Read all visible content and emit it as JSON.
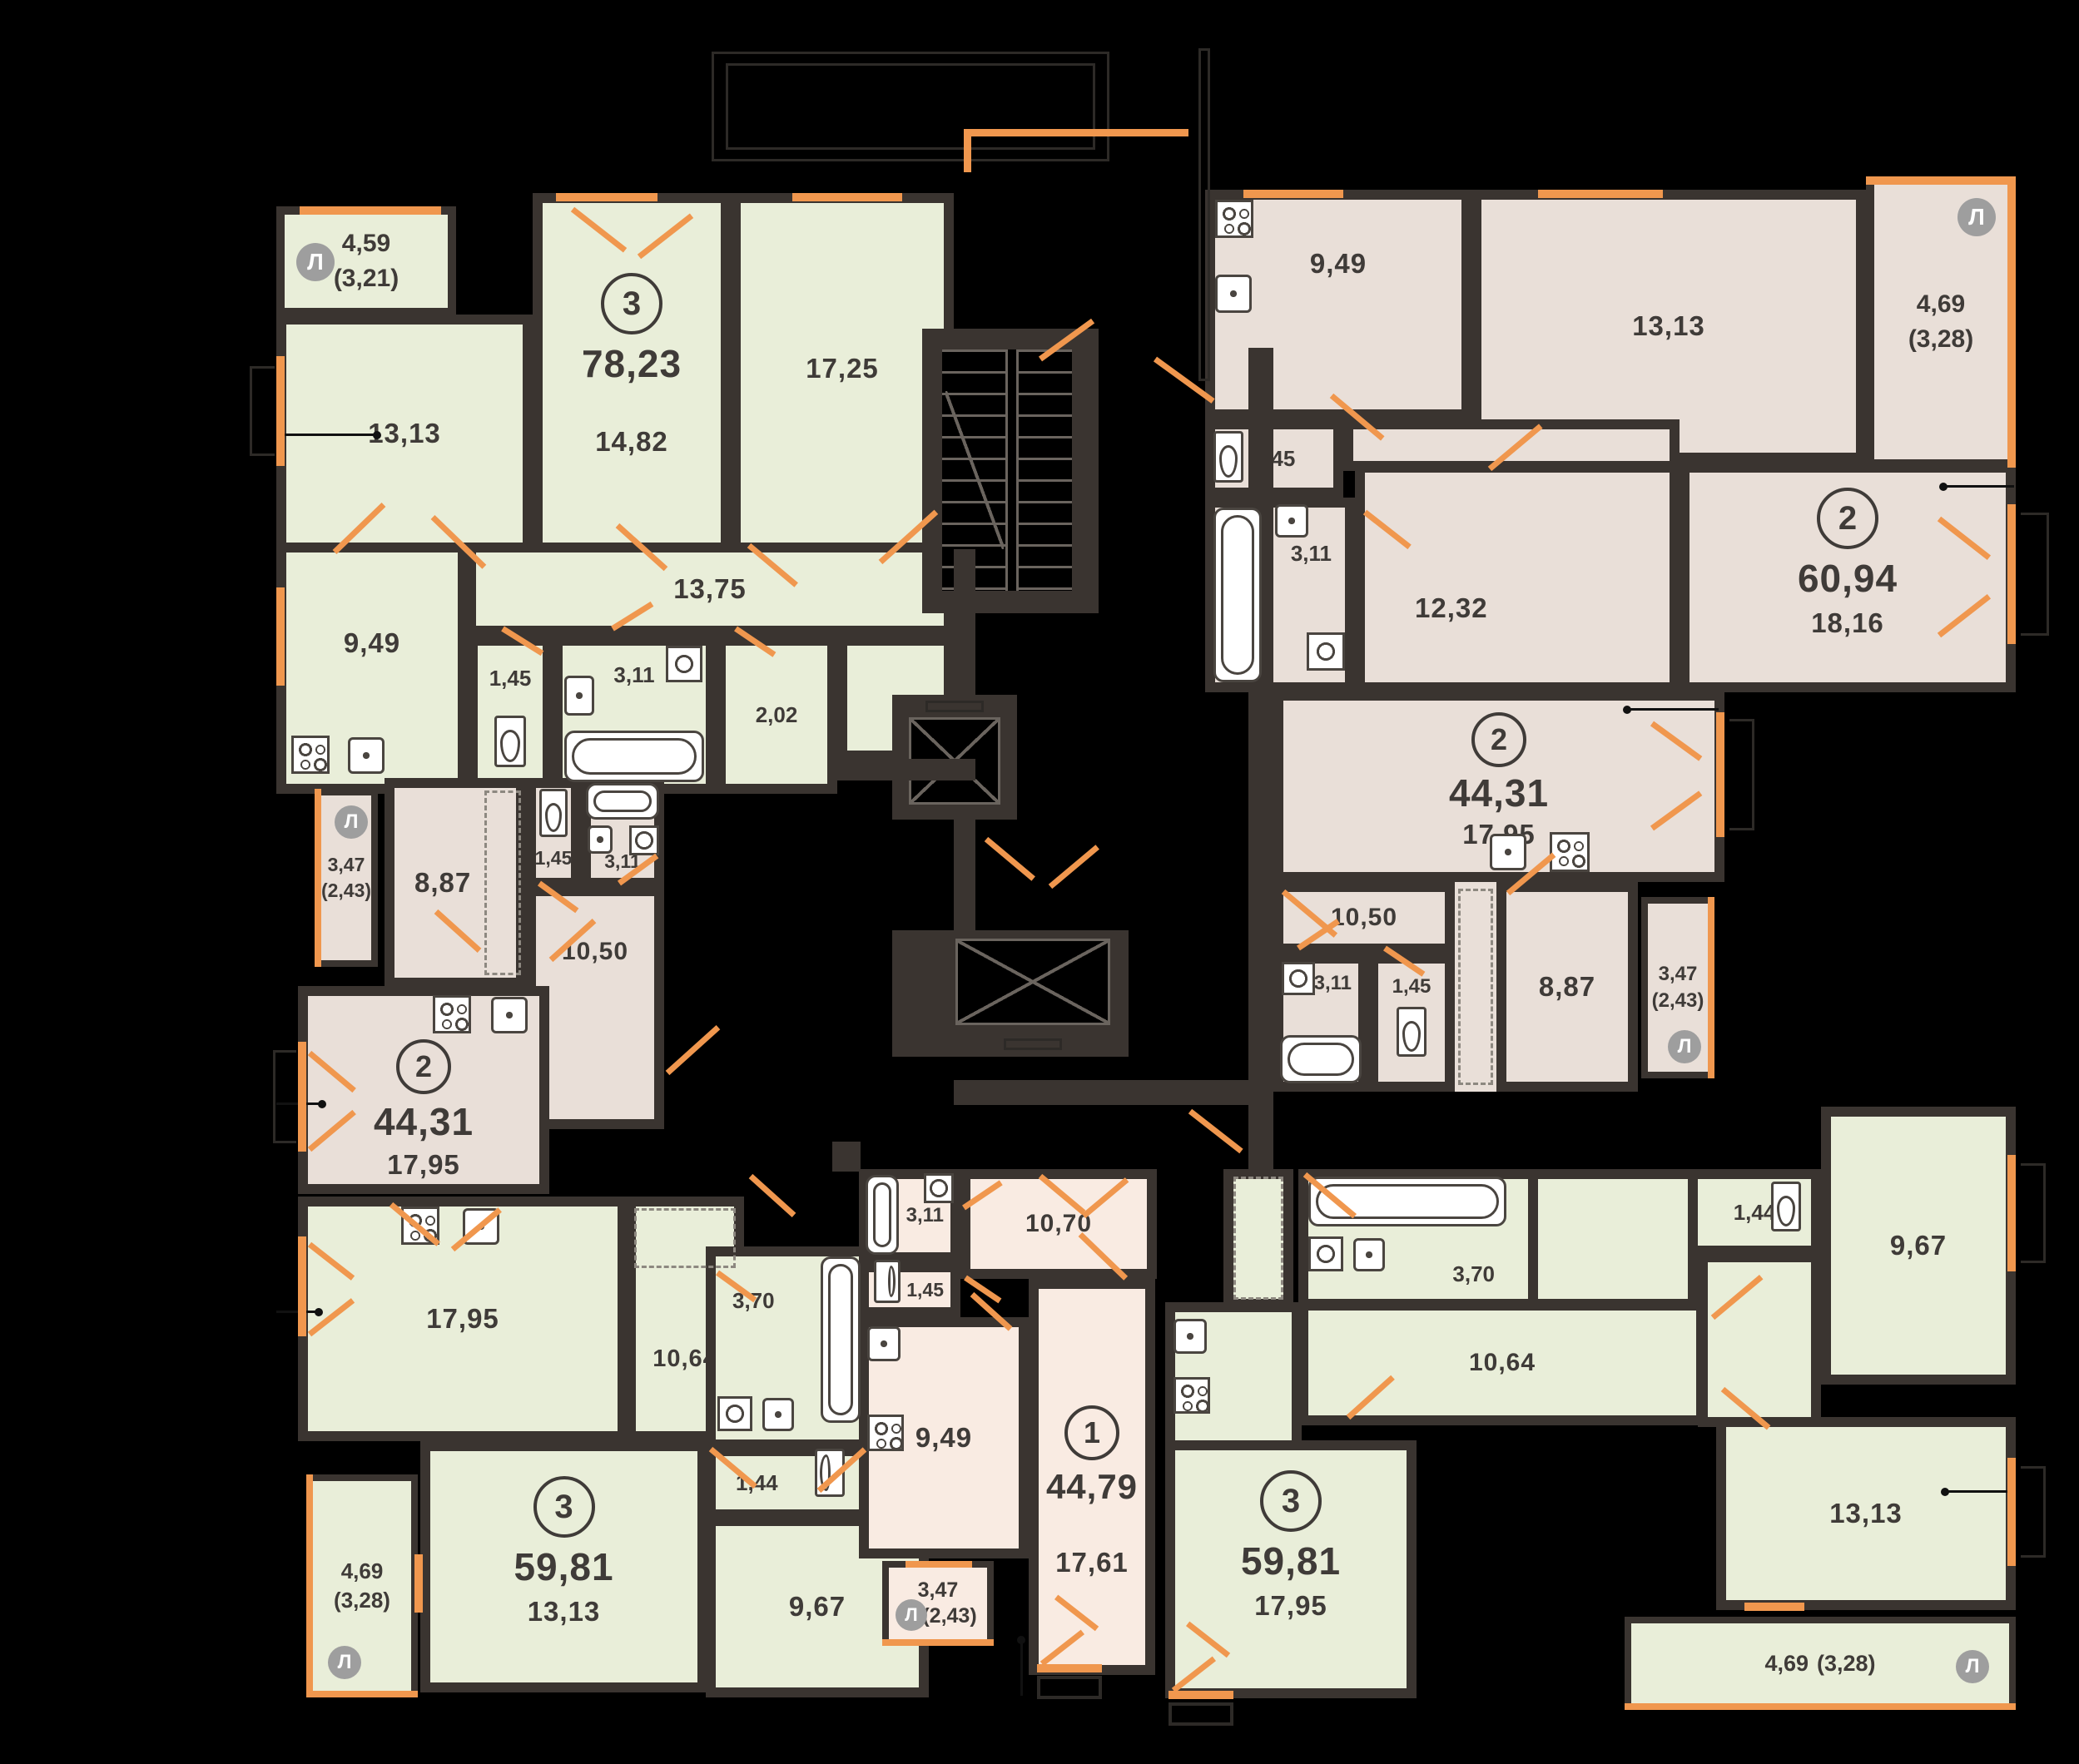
{
  "legend": {
    "loggia_badge": "Л"
  },
  "colors": {
    "background": "#000000",
    "walls": "#3a3430",
    "rooms_green": "#e9eed9",
    "rooms_taupe": "#e9dfd8",
    "rooms_pink": "#f9ebe2",
    "openings_orange": "#f0974e",
    "badge_gray": "#9e9e9e",
    "text": "#3f3b38"
  },
  "apartments": {
    "a1": {
      "num": "3",
      "area": "78,23",
      "rooms": {
        "loggia1": "4,59",
        "loggia2": "(3,21)",
        "r1313": "13,13",
        "r1482": "14,82",
        "r1725": "17,25",
        "hall": "13,75",
        "kitchen": "9,49",
        "wc": "1,45",
        "bath": "3,11",
        "store": "2,02"
      }
    },
    "a2": {
      "num": "2",
      "area": "60,94",
      "rooms": {
        "kitchen": "9,49",
        "r1313": "13,13",
        "loggia1": "4,69",
        "loggia2": "(3,28)",
        "wc": "1,45",
        "bath": "3,11",
        "hall": "12,32",
        "r1816": "18,16"
      }
    },
    "a3": {
      "num": "2",
      "area": "44,31",
      "rooms": {
        "kitchen": "17,95",
        "hall": "10,50",
        "bath": "3,11",
        "wc": "1,45",
        "r887": "8,87",
        "loggia1": "3,47",
        "loggia2": "(2,43)"
      }
    },
    "a4": {
      "num": "2",
      "area": "44,31",
      "rooms": {
        "loggia1": "3,47",
        "loggia2": "(2,43)",
        "r887": "8,87",
        "wc": "1,45",
        "bath": "3,11",
        "hall": "10,50",
        "kitchen": "17,95"
      }
    },
    "a5": {
      "num": "3",
      "area": "59,81",
      "rooms": {
        "kitchen": "17,95",
        "hall": "10,64",
        "bath": "3,70",
        "wc": "1,44",
        "r967": "9,67",
        "r1313": "13,13",
        "loggia1": "4,69",
        "loggia2": "(3,28)"
      }
    },
    "a6": {
      "num": "1",
      "area": "44,79",
      "rooms": {
        "bath": "3,11",
        "hall": "10,70",
        "wc": "1,45",
        "kitchen": "9,49",
        "r1761": "17,61",
        "loggia1": "3,47",
        "loggia2": "(2,43)"
      }
    },
    "a7": {
      "num": "3",
      "area": "59,81",
      "rooms": {
        "bath": "3,70",
        "wc": "1,44",
        "r967": "9,67",
        "hall": "10,64",
        "r1313": "13,13",
        "kitchen": "17,95",
        "loggia1": "4,69",
        "loggia2": "(3,28)"
      }
    }
  }
}
